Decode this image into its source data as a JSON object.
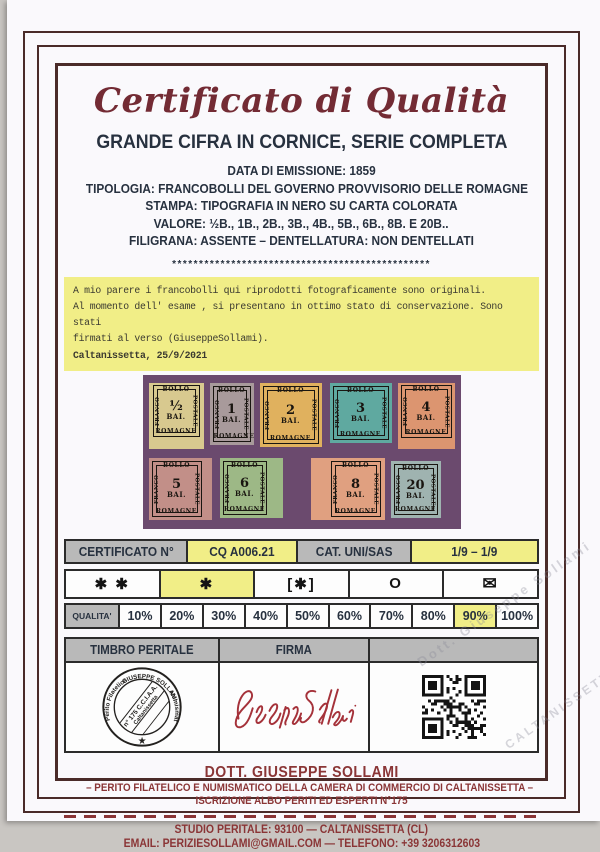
{
  "certificate": {
    "title": "Certificato di Qualità",
    "subtitle": "GRANDE CIFRA IN CORNICE, SERIE COMPLETA",
    "details": [
      "DATA DI EMISSIONE: 1859",
      "TIPOLOGIA: FRANCOBOLLI DEL GOVERNO PROVVISORIO DELLE ROMAGNE",
      "STAMPA: TIPOGRAFIA IN NERO SU CARTA COLORATA",
      "VALORE: ½B., 1B., 2B., 3B., 4B., 5B., 6B., 8B. E 20B..",
      "FILIGRANA: ASSENTE – DENTELLATURA: NON DENTELLATI"
    ],
    "separator": "************************************************"
  },
  "opinion": {
    "line1": "A mio parere i francobolli qui riprodotti fotograficamente sono originali.",
    "line2": "Al momento dell' esame , si presentano in ottimo stato di conservazione. Sono stati",
    "line3": "firmati al verso (GiuseppeSollami).",
    "dateline": "Caltanissetta, 25/9/2021"
  },
  "stamps": {
    "photo_background": "#6b4a6e",
    "unit": "BAI.",
    "frame_labels": {
      "top": "BOLLO",
      "left": "FRANCO",
      "right": "POSTALE",
      "bottom": "ROMAGNE"
    },
    "row1": [
      {
        "value": "½",
        "color": "#d8c98f"
      },
      {
        "value": "1",
        "color": "#a89a9b"
      },
      {
        "value": "2",
        "color": "#e0b15e"
      },
      {
        "value": "3",
        "color": "#5fa9a0"
      },
      {
        "value": "4",
        "color": "#dc9570"
      }
    ],
    "row2": [
      {
        "value": "5",
        "color": "#c28f88"
      },
      {
        "value": "6",
        "color": "#9db886"
      },
      {
        "value": "8",
        "color": "#e0a080"
      },
      {
        "value": "20",
        "color": "#9fb3b0"
      }
    ]
  },
  "cert_row": {
    "label_number": "CERTIFICATO N°",
    "number": "CQ A006.21",
    "label_cat": "CAT. UNI/SAS",
    "cat_value": "1/9 – 1/9"
  },
  "grading": {
    "mnh": "✱ ✱",
    "mh": "✱",
    "no_gum": "[✱]",
    "used": "O",
    "on_cover": "✉",
    "selected": "mh"
  },
  "quality": {
    "label": "QUALITA'",
    "percentages": [
      "10%",
      "20%",
      "30%",
      "40%",
      "50%",
      "60%",
      "70%",
      "80%",
      "90%",
      "100%"
    ],
    "selected": "90%"
  },
  "verification": {
    "stamp_header": "TIMBRO PERITALE",
    "signature_header": "FIRMA",
    "seal": {
      "ring_left": "Perito Filatelico",
      "ring_top": "GIUSEPPE SOLLAMI",
      "ring_right": "Numismatico",
      "inner_line1": "n° 175 C.C.I.A.A.",
      "inner_line2": "Caltanissetta",
      "star": "★"
    },
    "signature_name": "Giuseppe Sollami"
  },
  "footer": {
    "name": "DOTT. GIUSEPPE SOLLAMI",
    "role": "– PERITO FILATELICO E NUMISMATICO DELLA CAMERA DI COMMERCIO DI CALTANISSETTA –",
    "registration": "ISCRIZIONE ALBO PERITI ED ESPERTI N°175",
    "studio": "STUDIO PERITALE: 93100 — CALTANISSETTA (CL)",
    "contacts": "EMAIL: PERIZIESOLLAMI@GMAIL.COM — TELEFONO: +39 3206312603"
  },
  "watermark": {
    "text1": "Dott. Giuseppe Sollami",
    "text2": "CALTANISSETTA"
  },
  "colors": {
    "accent_red": "#732b34",
    "footer_red": "#8a3536",
    "navy": "#27313f",
    "highlight_yellow": "#f1ee87",
    "header_gray": "#b9b9b9",
    "frame_brown": "#4a2b29",
    "photo_purple": "#6b4a6e",
    "signature_red": "#a5323a"
  }
}
